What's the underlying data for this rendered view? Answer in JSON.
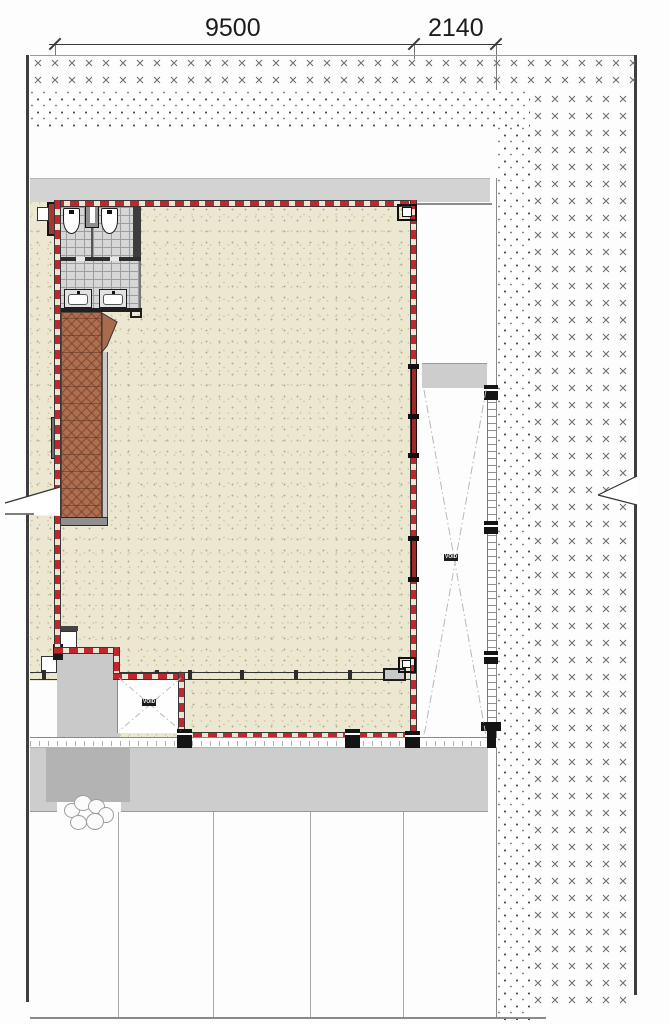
{
  "dimension_labels": {
    "left_span": "9500",
    "right_span": "2140"
  },
  "void_labels": {
    "courtyard": "VOID",
    "shaft": "VOID"
  },
  "palette": {
    "outline_red": "#bf272c",
    "floor_beige": "#ebe7d1",
    "stair_terracotta": "#ad6e51",
    "tile_gray": "#d6d6d6",
    "paving_gray": "#cdcdcd",
    "dark_paving_gray": "#b3b3b3",
    "hatch_mark_gray": "#6f6f6f",
    "wall_black": "#1a1a1a"
  },
  "symbols": {
    "toilets": 2,
    "sinks": 2,
    "columns_bottom": 3,
    "columns_right": 4
  }
}
